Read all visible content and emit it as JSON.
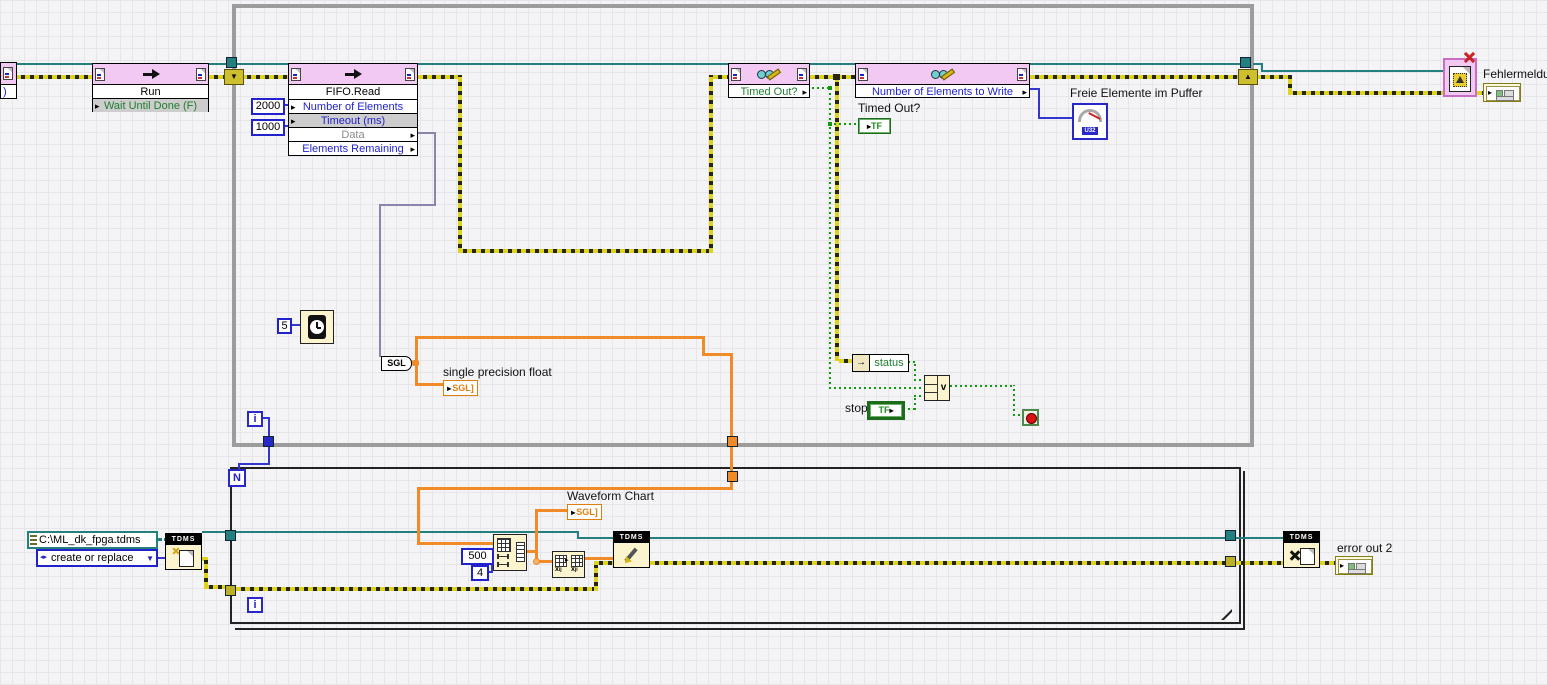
{
  "diagram": {
    "while_loop": {
      "iteration_label": "i"
    },
    "for_loop": {
      "count_label": "N",
      "iteration_label": "i"
    }
  },
  "nodes": {
    "edge_stub": {
      "text": ")"
    },
    "run_invoke": {
      "title": "Run",
      "param": "Wait Until Done (F)"
    },
    "fifo_read_invoke": {
      "title": "FIFO.Read",
      "param_elements": "Number of Elements",
      "param_timeout": "Timeout (ms)",
      "param_data": "Data",
      "param_remaining": "Elements Remaining"
    },
    "timed_out_property": {
      "param": "Timed Out?"
    },
    "elements_to_write_property": {
      "param": "Number of Elements to Write"
    },
    "to_sgl_convert": {
      "label": "SGL"
    },
    "unbundle_by_name": {
      "field": "status"
    },
    "or_function": {
      "symbol": "v"
    },
    "tdms_open": {
      "header": "TDMS"
    },
    "tdms_write": {
      "header": "TDMS"
    },
    "tdms_close": {
      "header": "TDMS"
    }
  },
  "constants": {
    "number_of_elements": "2000",
    "timeout_ms": "1000",
    "wait_ms": "5",
    "reshape_dim1": "500",
    "reshape_dim2": "4",
    "file_path": "C:\\ML_dk_fpga.tdms",
    "open_mode": "create or replace"
  },
  "indicators": {
    "free_elements_gauge": {
      "label": "Freie Elemente im Puffer",
      "datatype": "U32"
    },
    "timed_out": {
      "label": "Timed Out?",
      "datatype": "TF"
    },
    "single_precision_float": {
      "label": "single precision float",
      "datatype": "SGL]"
    },
    "waveform_chart": {
      "label": "Waveform Chart",
      "datatype": "SGL]"
    },
    "error_out_2": {
      "label": "error out 2"
    },
    "fehlermeldung": {
      "label": "Fehlermeldung"
    }
  },
  "controls": {
    "stop": {
      "label": "stop",
      "datatype": "TF"
    }
  }
}
